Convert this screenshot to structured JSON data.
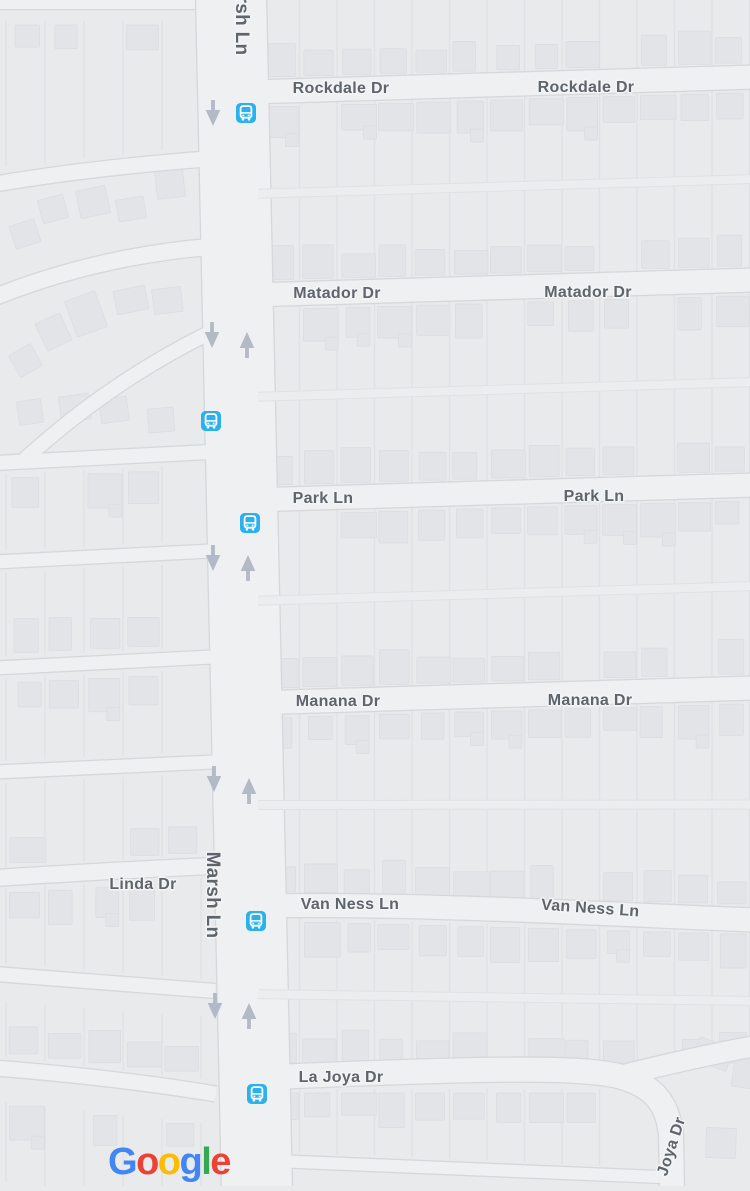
{
  "app": {
    "type": "map-viewport",
    "provider": "Google"
  },
  "colors": {
    "map_background": "#e9eaec",
    "road_fill": "#eff0f2",
    "road_casing": "#d5d7da",
    "parcel_line": "#dfe1e4",
    "alley_fill": "#ecedef",
    "alley_edge": "#e0e2e5",
    "building_fill": "#e3e4e7",
    "building_stroke": "#dadce0",
    "label_text": "#5f656c",
    "label_halo": "#f3f4f5",
    "transit_blue": "#2bb1ec",
    "transit_glyph": "#ffffff",
    "arrow_color": "#b3b9c6"
  },
  "streets": [
    {
      "name": "Rockdale Dr",
      "labels": [
        {
          "x": 341,
          "y": 93
        },
        {
          "x": 586,
          "y": 92
        }
      ]
    },
    {
      "name": "Matador Dr",
      "labels": [
        {
          "x": 337,
          "y": 298
        },
        {
          "x": 588,
          "y": 297
        }
      ]
    },
    {
      "name": "Park Ln",
      "labels": [
        {
          "x": 323,
          "y": 503
        },
        {
          "x": 594,
          "y": 501
        }
      ]
    },
    {
      "name": "Manana Dr",
      "labels": [
        {
          "x": 338,
          "y": 706
        },
        {
          "x": 590,
          "y": 705
        }
      ]
    },
    {
      "name": "Van Ness Ln",
      "labels": [
        {
          "x": 350,
          "y": 909
        },
        {
          "x": 590,
          "y": 913,
          "rotate": 4
        }
      ]
    },
    {
      "name": "La Joya Dr",
      "labels": [
        {
          "x": 341,
          "y": 1082
        }
      ]
    },
    {
      "name": "Joya Dr",
      "labels": [
        {
          "x": 676,
          "y": 1148,
          "rotate": -72
        }
      ]
    },
    {
      "name": "Linda Dr",
      "labels": [
        {
          "x": 143,
          "y": 889
        }
      ]
    },
    {
      "name": "Marsh Ln",
      "labels": [
        {
          "x": 207,
          "y": 895,
          "rotate": 90,
          "size": 19,
          "spacing": 2.5
        },
        {
          "x": 236,
          "y": 12,
          "rotate": 90,
          "size": 19,
          "spacing": 2.5
        }
      ]
    }
  ],
  "transit_stops": [
    {
      "x": 246,
      "y": 113
    },
    {
      "x": 211,
      "y": 421
    },
    {
      "x": 250,
      "y": 523
    },
    {
      "x": 256,
      "y": 921
    },
    {
      "x": 257,
      "y": 1094
    }
  ],
  "traffic_arrows": [
    {
      "dir": "down",
      "x": 213,
      "y": 113
    },
    {
      "dir": "down",
      "x": 212,
      "y": 335
    },
    {
      "dir": "up",
      "x": 247,
      "y": 345
    },
    {
      "dir": "down",
      "x": 213,
      "y": 558
    },
    {
      "dir": "up",
      "x": 248,
      "y": 568
    },
    {
      "dir": "down",
      "x": 214,
      "y": 779
    },
    {
      "dir": "up",
      "x": 249,
      "y": 791
    },
    {
      "dir": "down",
      "x": 215,
      "y": 1006
    },
    {
      "dir": "up",
      "x": 249,
      "y": 1016
    }
  ],
  "google_logo": {
    "letters": [
      {
        "ch": "G",
        "color": "#4285F4"
      },
      {
        "ch": "o",
        "color": "#EA4335"
      },
      {
        "ch": "o",
        "color": "#FBBC05"
      },
      {
        "ch": "g",
        "color": "#4285F4"
      },
      {
        "ch": "l",
        "color": "#34A853"
      },
      {
        "ch": "e",
        "color": "#EA4335"
      }
    ]
  }
}
